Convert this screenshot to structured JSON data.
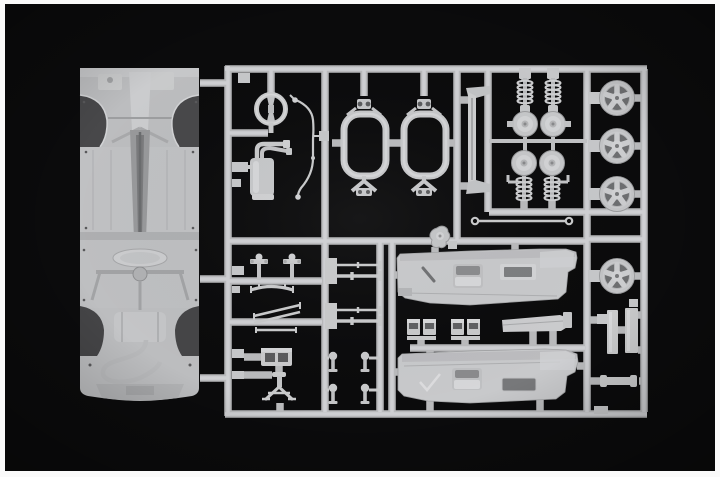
{
  "scene": {
    "type": "photograph",
    "subject": "injection-molded plastic model kit sprue (parts tree) for a scale model car, light grey styrene on black background with white photo border",
    "palette": {
      "background": "#0b0b0c",
      "frame": "#fafafa",
      "plastic": "#c9cacb",
      "plastic_highlight": "#d6d7d9",
      "plastic_shadow": "#9a9b9d",
      "dark_recess": "#4a4a4c"
    },
    "parts": [
      {
        "id": "chassis-part",
        "label": "car chassis underbody pan"
      },
      {
        "id": "steering-wheel-part",
        "label": "steering wheel"
      },
      {
        "id": "muffler-part",
        "label": "exhaust muffler with twin pipes"
      },
      {
        "id": "brake-line-part",
        "label": "bent brake/fuel line"
      },
      {
        "id": "subframe-part-a",
        "label": "suspension subframe A"
      },
      {
        "id": "subframe-part-b",
        "label": "suspension subframe B"
      },
      {
        "id": "valance-part",
        "label": "tall curved valance / sill panel"
      },
      {
        "id": "shock-absorbers",
        "label": "two coil-over shock absorbers"
      },
      {
        "id": "brake-hubs",
        "label": "four brake hub / disc assemblies"
      },
      {
        "id": "springs-bottom",
        "label": "two coil springs with brackets"
      },
      {
        "id": "sway-bar-rod",
        "label": "thin linkage rod with eyelets"
      },
      {
        "id": "wheels",
        "label": "four five-spoke wheel rims",
        "count": 4
      },
      {
        "id": "plate-parts",
        "label": "two rectangular plates"
      },
      {
        "id": "strip-part",
        "label": "small bone-shaped strip"
      },
      {
        "id": "control-arm-pins",
        "label": "small control-arm pin parts"
      },
      {
        "id": "tie-rod-diagonals",
        "label": "diagonal tie rods"
      },
      {
        "id": "gearbox-box-part",
        "label": "small box part with openings"
      },
      {
        "id": "tripod-part",
        "label": "tripod / jack-stand part"
      },
      {
        "id": "axle-rods",
        "label": "axle rods with flanged ends"
      },
      {
        "id": "ball-pins",
        "label": "small ball-end pins"
      },
      {
        "id": "fuel-pump-part",
        "label": "small organic pump part"
      },
      {
        "id": "door-panel-top",
        "label": "interior door card (upper)"
      },
      {
        "id": "door-panel-bottom",
        "label": "interior door card (lower)"
      },
      {
        "id": "hinge-boxes",
        "label": "paired hinge/latch boxes"
      },
      {
        "id": "tray-part",
        "label": "long flat tray part"
      }
    ]
  }
}
